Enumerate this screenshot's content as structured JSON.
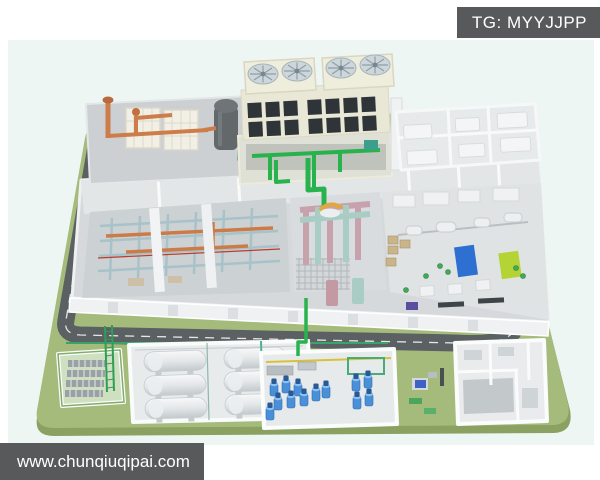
{
  "window": {
    "width": 600,
    "height": 480,
    "background": "#ffffff"
  },
  "overlays": {
    "telegram_badge": {
      "label": "TG: MYYJJPP",
      "background": "#58595b",
      "text_color": "#ffffff"
    },
    "website_bar": {
      "label": "www.chunqiuqipai.com",
      "background": "#58595b",
      "text_color": "#ffffff"
    }
  },
  "scene": {
    "kind": "3d-isometric-cutaway-render",
    "subject": "industrial process plant complex on a green site with ring road",
    "areas": [
      {
        "name": "cooling-tower-block",
        "detail": "rooftop unit with 4 circular fans and dark louver grid"
      },
      {
        "name": "piping-skid",
        "detail": "orange piping with dark vertical vessel on top-left platform"
      },
      {
        "name": "auxiliary-rooms",
        "detail": "top-right cutaway rooms with white equipment boxes"
      },
      {
        "name": "turbine-hall",
        "detail": "left hall with steel framework, orange pipes, white beams"
      },
      {
        "name": "central-process-hall",
        "detail": "pink and teal gantry frames over gridded floor"
      },
      {
        "name": "machine-hall",
        "detail": "right hall with blue and lime machine units on a shaft line"
      },
      {
        "name": "ring-road",
        "detail": "dark loop road with dashed lane marking"
      },
      {
        "name": "cooling-unit-pit",
        "detail": "small walled pit with finned units, bottom-left"
      },
      {
        "name": "pipe-bridge",
        "detail": "green pipe rack running from plant toward tank farm"
      },
      {
        "name": "tank-farm",
        "detail": "six horizontal cylindrical storage tanks in a white bund"
      },
      {
        "name": "pump-station",
        "detail": "room with blue vertical pumps and yellow header pipe"
      },
      {
        "name": "equipment-pad",
        "detail": "small outdoor units between pump station and utility building"
      },
      {
        "name": "utility-building",
        "detail": "bottom-right cutaway building with partition walls"
      }
    ],
    "palette": {
      "background_tint": "#eef6f4",
      "grass": "#a5bb7c",
      "grass_edge": "#8aa162",
      "road": "#5b6063",
      "road_dash": "#e4e7e7",
      "wall_white": "#f3f4f5",
      "floor_gray": "#d6d9db",
      "steel_frame": "#a7c2c9",
      "orange_pipe": "#cc7b47",
      "pink_gantry": "#c7a2ac",
      "teal_gantry": "#a9cdc4",
      "bright_green_pipe": "#29b34e",
      "yellow_pipe": "#d9c23a",
      "blue_machine": "#2e6fd2",
      "lime_machine": "#b4d335",
      "pump_blue": "#4a90d9",
      "cooling_tower_cream": "#e9e7d5",
      "louver_dark": "#2e3437",
      "vessel_dark": "#63686b"
    }
  }
}
